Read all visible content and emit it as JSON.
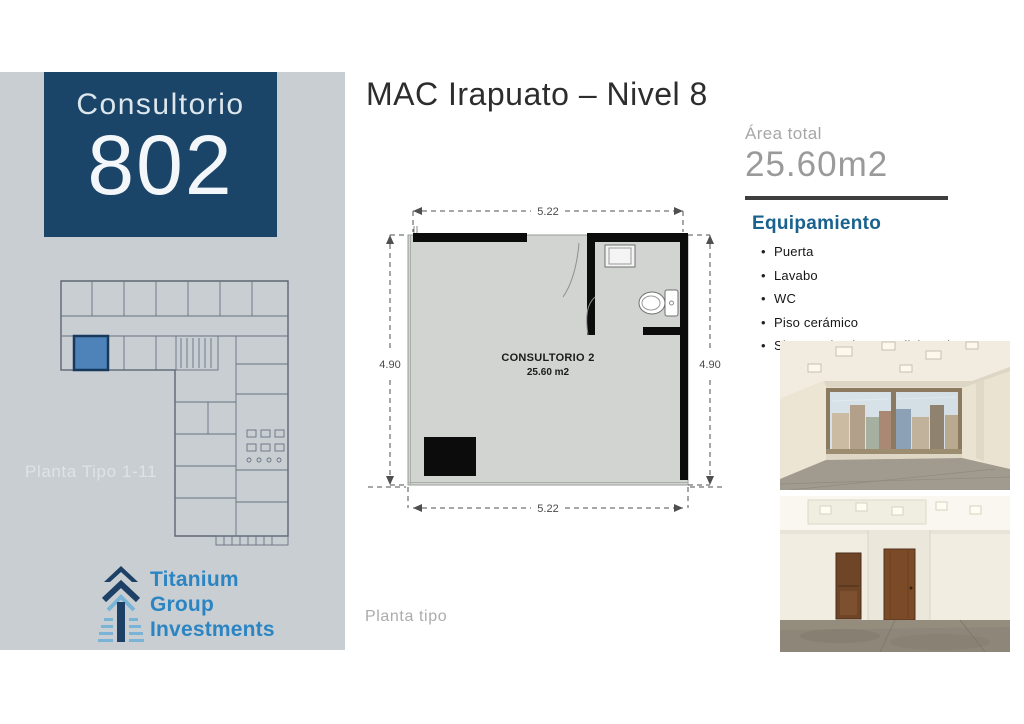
{
  "colors": {
    "sidebar_bg": "#c9ced3",
    "unit_card_bg": "#1b4568",
    "highlight_blue": "#4d83b8",
    "heading_blue": "#19618e",
    "logo_blue": "#2c85c3",
    "logo_navy": "#1d4166",
    "logo_light_blue": "#79b4d6"
  },
  "sidebar": {
    "unit_card": {
      "label": "Consultorio",
      "number": "802"
    },
    "floor_caption": "Planta Tipo 1-11",
    "logo": {
      "lines": [
        "Titanium",
        "Group",
        "Investments"
      ]
    }
  },
  "header": {
    "title": "MAC Irapuato – Nivel 8"
  },
  "plan": {
    "dim_top": "5.22",
    "dim_bottom": "5.22",
    "dim_left": "4.90",
    "dim_right": "4.90",
    "room_label": "CONSULTORIO 2",
    "room_area": "25.60 m2",
    "caption": "Planta tipo"
  },
  "details": {
    "area_label": "Área total",
    "area_value": "25.60m2",
    "equipment_title": "Equipamiento",
    "equipment_items": [
      "Puerta",
      "Lavabo",
      "WC",
      "Piso cerámico",
      "Sistema de aire acondicionado"
    ]
  }
}
